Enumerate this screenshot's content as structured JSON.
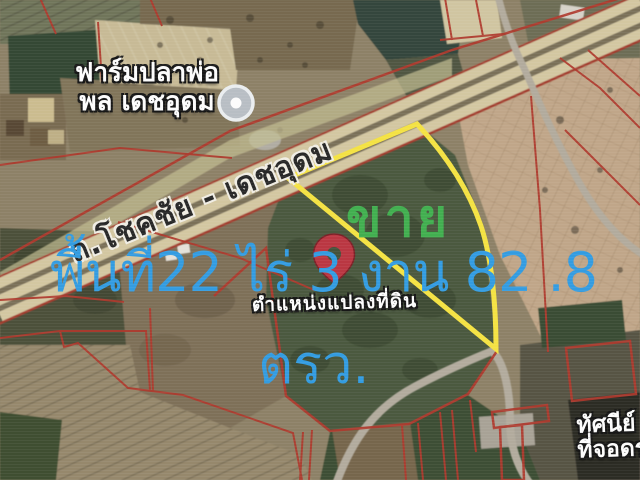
{
  "poi_farm": {
    "line1": "ฟาร์มปลาพ่อ",
    "line2": "พล เดชอุดม"
  },
  "road": {
    "name": "ถ.โชคชัย - เดชอุดม"
  },
  "listing": {
    "sale": "ขาย",
    "area_line1": "พื้นที่22 ไร่ 3 งาน 82 .8",
    "area_line2": "ตรว.",
    "pin_caption": "ตำแหน่งแปลงที่ดิน"
  },
  "corner_poi": {
    "line1": "ทัศนีย์",
    "line2": "ที่จอดรถ"
  },
  "colors": {
    "area_text": "#2d9ee8",
    "sale_text": "#3cb24b",
    "plot_outline": "#f8e43a",
    "parcel_line": "#b5372a",
    "pin_fill": "#c13440",
    "pin_stroke": "#801f26",
    "highway_fill": "#d5c8a0"
  }
}
